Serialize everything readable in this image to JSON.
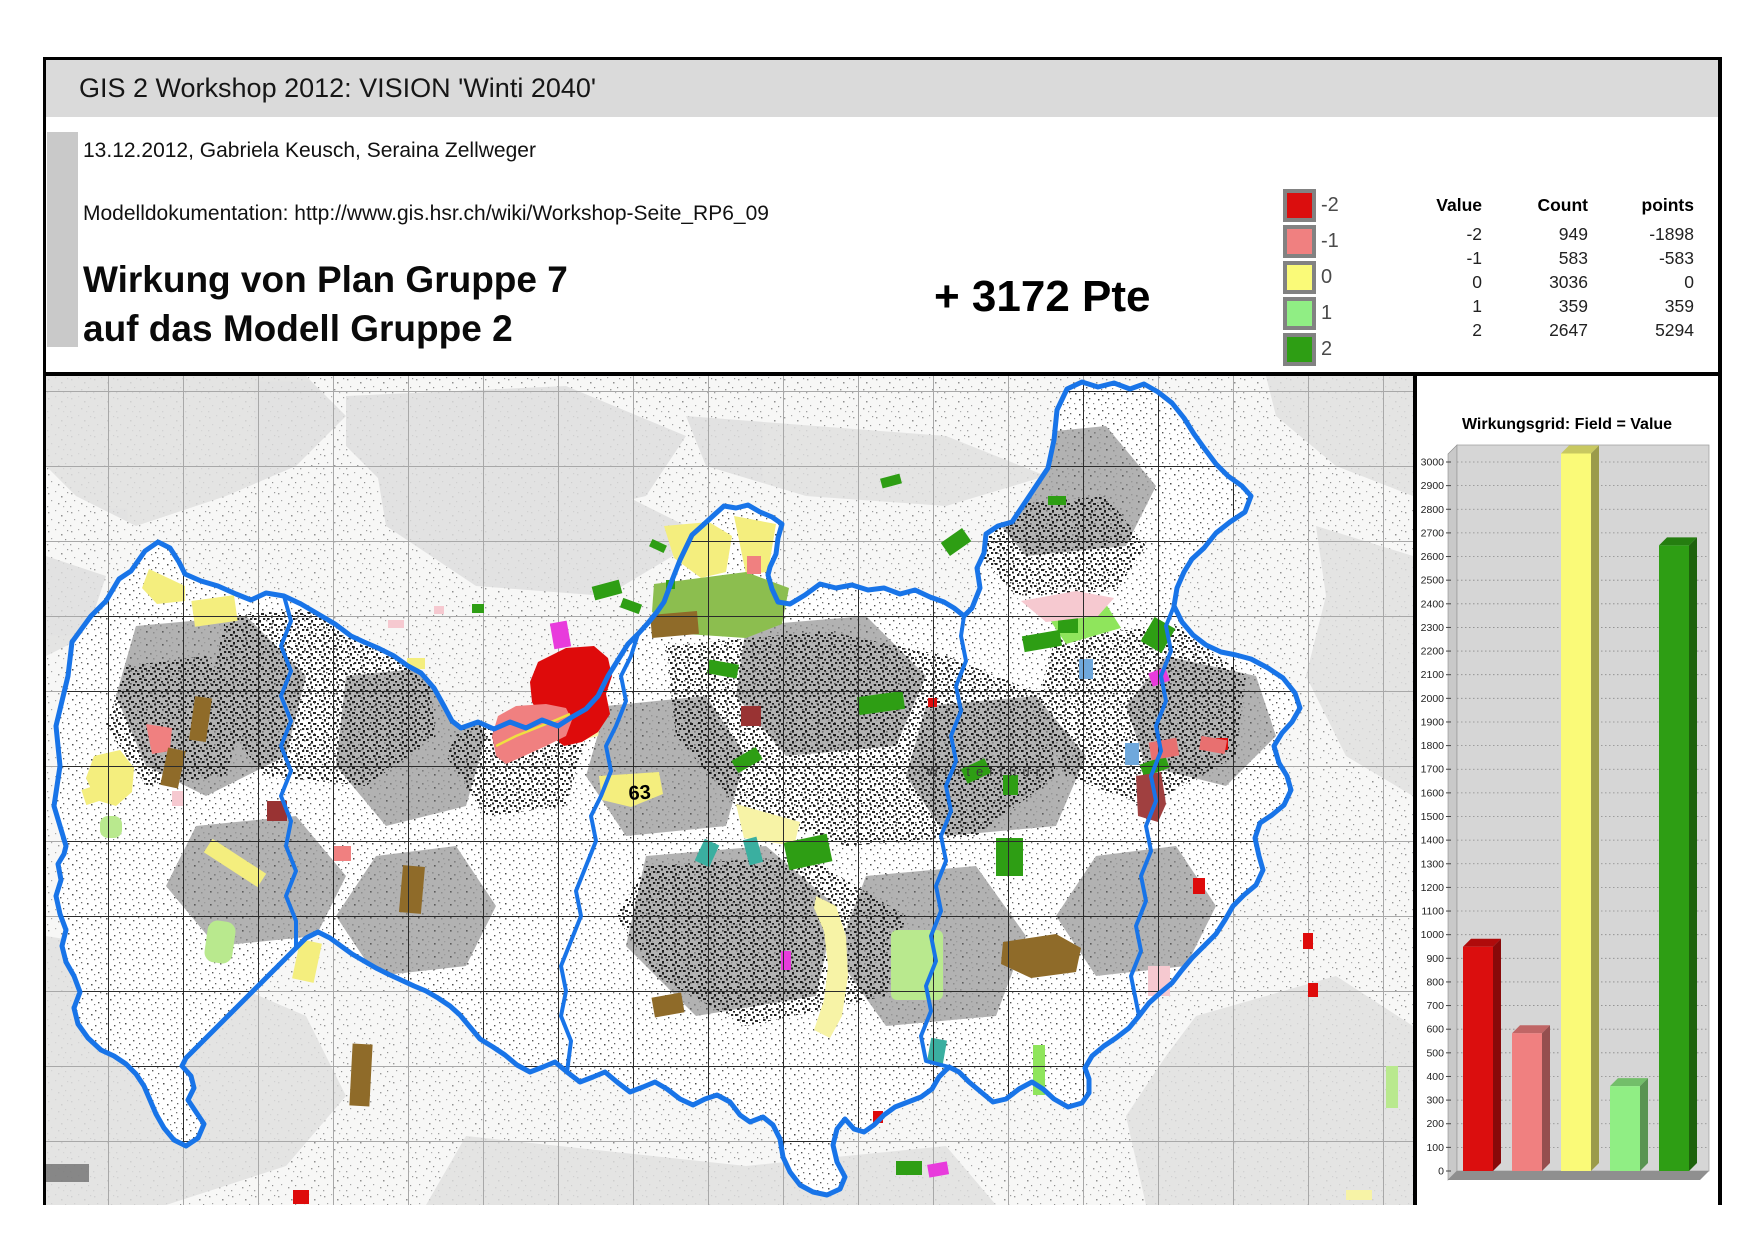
{
  "header": {
    "app_title": "GIS 2 Workshop 2012: VISION 'Winti 2040'",
    "subtitle": "13.12.2012, Gabriela Keusch, Seraina Zellweger",
    "doc_line": "Modelldokumentation: http://www.gis.hsr.ch/wiki/Workshop-Seite_RP6_09",
    "title_line1": "Wirkung von Plan Gruppe 7",
    "title_line2": "auf das Modell Gruppe 2",
    "points_total": "+ 3172 Pte"
  },
  "legend": {
    "items": [
      {
        "label": "-2",
        "color": "#db0e0e"
      },
      {
        "label": "-1",
        "color": "#f08080"
      },
      {
        "label": "0",
        "color": "#fafa78"
      },
      {
        "label": "1",
        "color": "#90ee84"
      },
      {
        "label": "2",
        "color": "#2e9e14"
      }
    ]
  },
  "stats_table": {
    "columns": [
      "Value",
      "Count",
      "points"
    ],
    "rows": [
      [
        "-2",
        "949",
        "-1898"
      ],
      [
        "-1",
        "583",
        "-583"
      ],
      [
        "0",
        "3036",
        "0"
      ],
      [
        "1",
        "359",
        "359"
      ],
      [
        "2",
        "2647",
        "5294"
      ]
    ]
  },
  "map": {
    "boundary_color": "#1874e8",
    "labels": {
      "area_code": "63",
      "city": "Winterthur"
    }
  },
  "chart_data": {
    "type": "bar",
    "title": "Wirkungsgrid: Field = Value",
    "categories": [
      "-2",
      "-1",
      "0",
      "1",
      "2"
    ],
    "values": [
      949,
      583,
      3036,
      359,
      2647
    ],
    "colors": [
      "#db0e0e",
      "#f08080",
      "#fafa78",
      "#90ee84",
      "#2e9e14"
    ],
    "xlabel": "",
    "ylabel": "",
    "ylim": [
      0,
      3064
    ],
    "ytick_step": 100,
    "grid": "dotted-horizontal",
    "legend_position": "none",
    "style": "3d-column"
  }
}
